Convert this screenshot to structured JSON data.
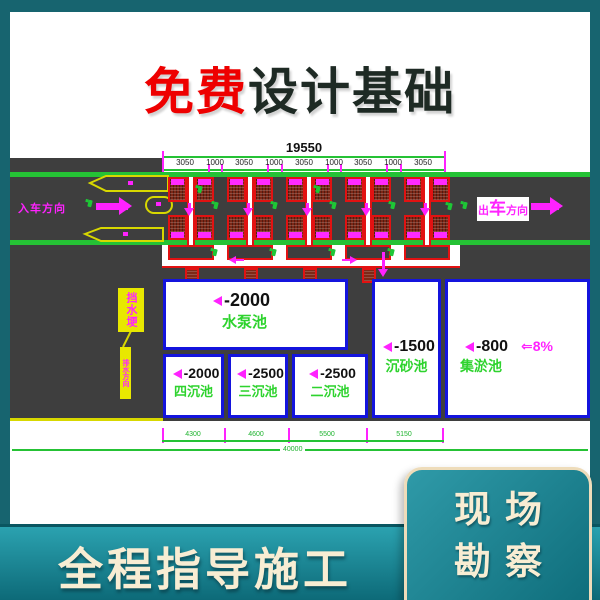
{
  "header": {
    "highlight": "免费",
    "title": "设计基础"
  },
  "drawing": {
    "total_dim": "19550",
    "sub_dims": [
      "3050",
      "1000",
      "3050",
      "1000",
      "3050",
      "1000",
      "3050",
      "1000",
      "3050"
    ],
    "entry_label": "入车方向",
    "exit_label_p1": "出",
    "exit_label_p2": "车",
    "exit_label_p3": "方向",
    "callout_label": "挡水埂",
    "callout_note": "排水方向",
    "pools": {
      "pump": {
        "depth": "-2000",
        "name": "水泵池"
      },
      "p4": {
        "depth": "-2000",
        "name": "四沉池"
      },
      "p3": {
        "depth": "-2500",
        "name": "三沉池"
      },
      "p2": {
        "depth": "-2500",
        "name": "二沉池"
      },
      "grit": {
        "depth": "-1500",
        "name": "沉砂池"
      },
      "silt": {
        "depth": "-800",
        "name": "集淤池"
      }
    },
    "slope_label": "⇐8%",
    "bottom_dims": [
      "4300",
      "4600",
      "5500",
      "5150"
    ],
    "overall_dim": "40000"
  },
  "banner": {
    "text": "全程指导施工"
  },
  "badge": {
    "line1": "现场",
    "line2": "勘察"
  },
  "colors": {
    "teal": "#17646f",
    "banner_top": "#2ba2b0",
    "banner_bottom": "#0d6a78",
    "cream": "#f8edd3",
    "headline_red": "#ee0000",
    "magenta": "#ff22ff",
    "cad_green": "#25c235",
    "pool_blue": "#1414dd",
    "road_gray": "#3e3e3e",
    "hatch_red": "#7d2817",
    "yellow": "#d8d800"
  }
}
